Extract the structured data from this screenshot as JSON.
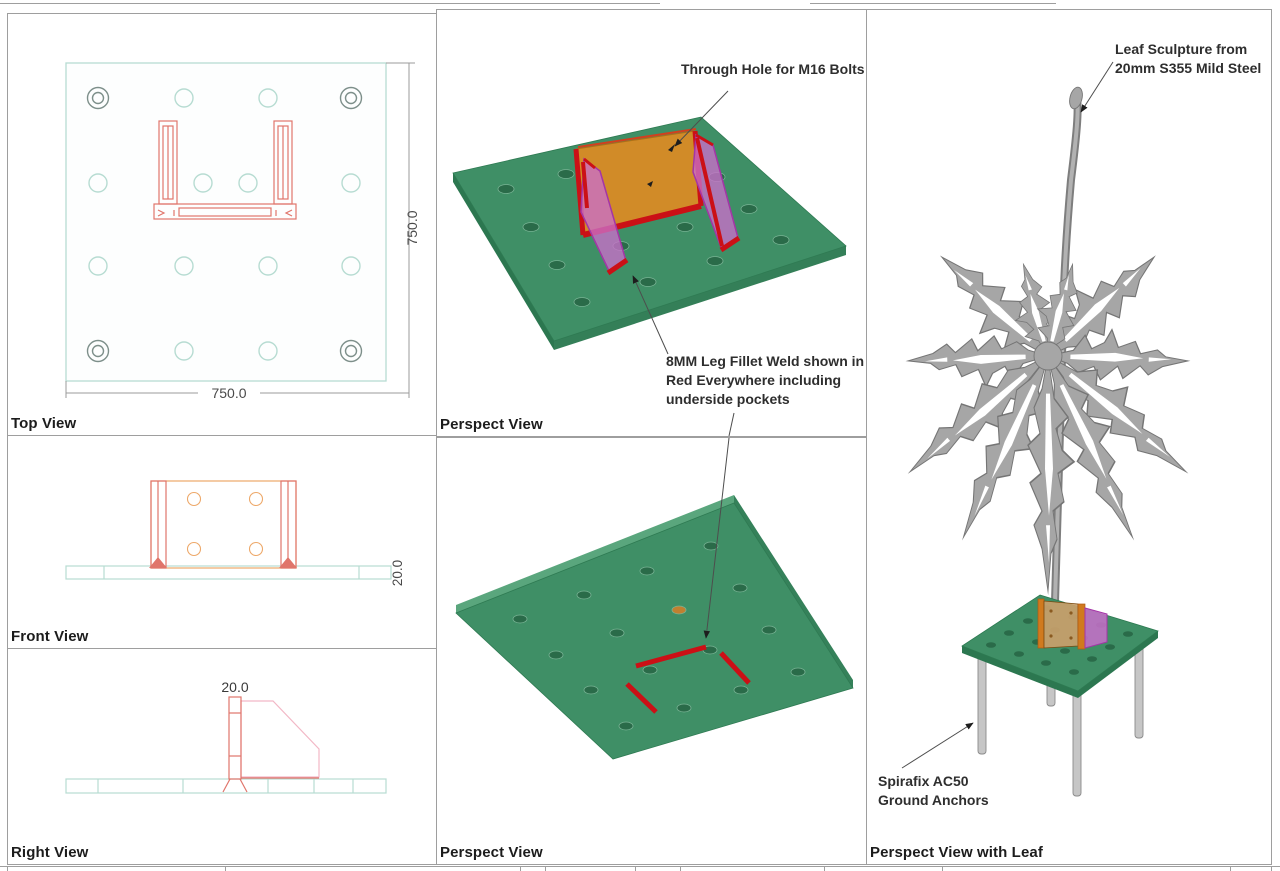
{
  "sheet": {
    "top_view": {
      "label": "Top View",
      "dim_width": "750.0",
      "dim_height": "750.0"
    },
    "front_view": {
      "label": "Front View",
      "dim_thickness": "20.0"
    },
    "right_view": {
      "label": "Right View",
      "dim_thickness": "20.0"
    },
    "persp_weld_top": {
      "label": "Perspect View",
      "hole_note": "Through Hole for M16 Bolts",
      "weld_note_lines": [
        "8MM Leg Fillet Weld shown in",
        "Red Everywhere including",
        "underside pockets"
      ]
    },
    "persp_weld_bottom": {
      "label": "Perspect View"
    },
    "persp_leaf": {
      "label": "Perspect View with Leaf",
      "leaf_note_lines": [
        "Leaf Sculpture from",
        "20mm S355 Mild Steel"
      ],
      "anchor_note_lines": [
        "Spirafix AC50",
        "Ground Anchors"
      ]
    }
  },
  "colors": {
    "plate_green": "#3f8f66",
    "plate_green_edge": "#2c7750",
    "plate_green_light_edge": "#5aa67d",
    "hole_green": "#2a6b49",
    "weld_red": "#cb1016",
    "bracket_orange": "#d18b28",
    "gusset_magenta": "#c96fcb",
    "leaf_gray": "#a6a6a6",
    "anchor_gray": "#c6c6c6",
    "cad_outline_teal": "#b7dcd2",
    "cad_line_red": "#e0756b",
    "cad_line_pink": "#f2b8c6",
    "dimension_gray": "#4a4a4a",
    "panel_border_gray": "#9e9e9e"
  }
}
